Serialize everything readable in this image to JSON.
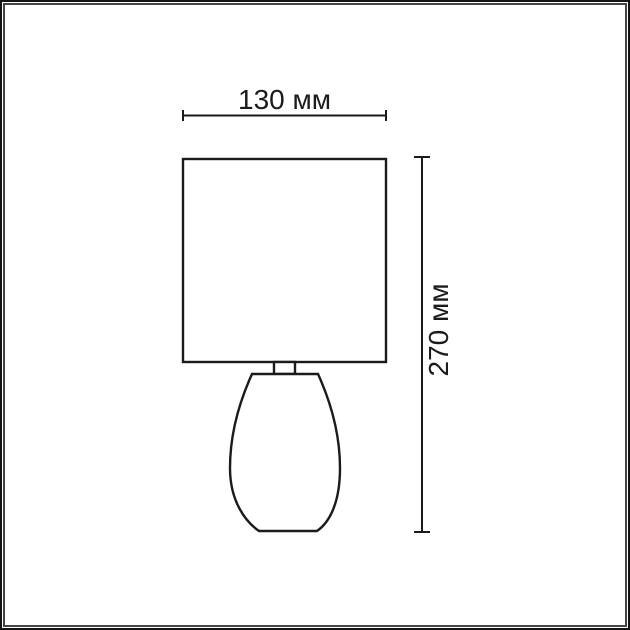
{
  "page": {
    "background": "#ffffff",
    "frame": {
      "outer_color": "#141414",
      "gap_color": "#ffffff",
      "inner_color": "#454545"
    }
  },
  "drawing": {
    "kind": "table-lamp-dimension-diagram",
    "line_color": "#1b1b1b",
    "width_dimension": {
      "label": "130 мм",
      "value": 130,
      "unit": "мм"
    },
    "height_dimension": {
      "label": "270 мм",
      "value": 270,
      "unit": "мм"
    }
  }
}
